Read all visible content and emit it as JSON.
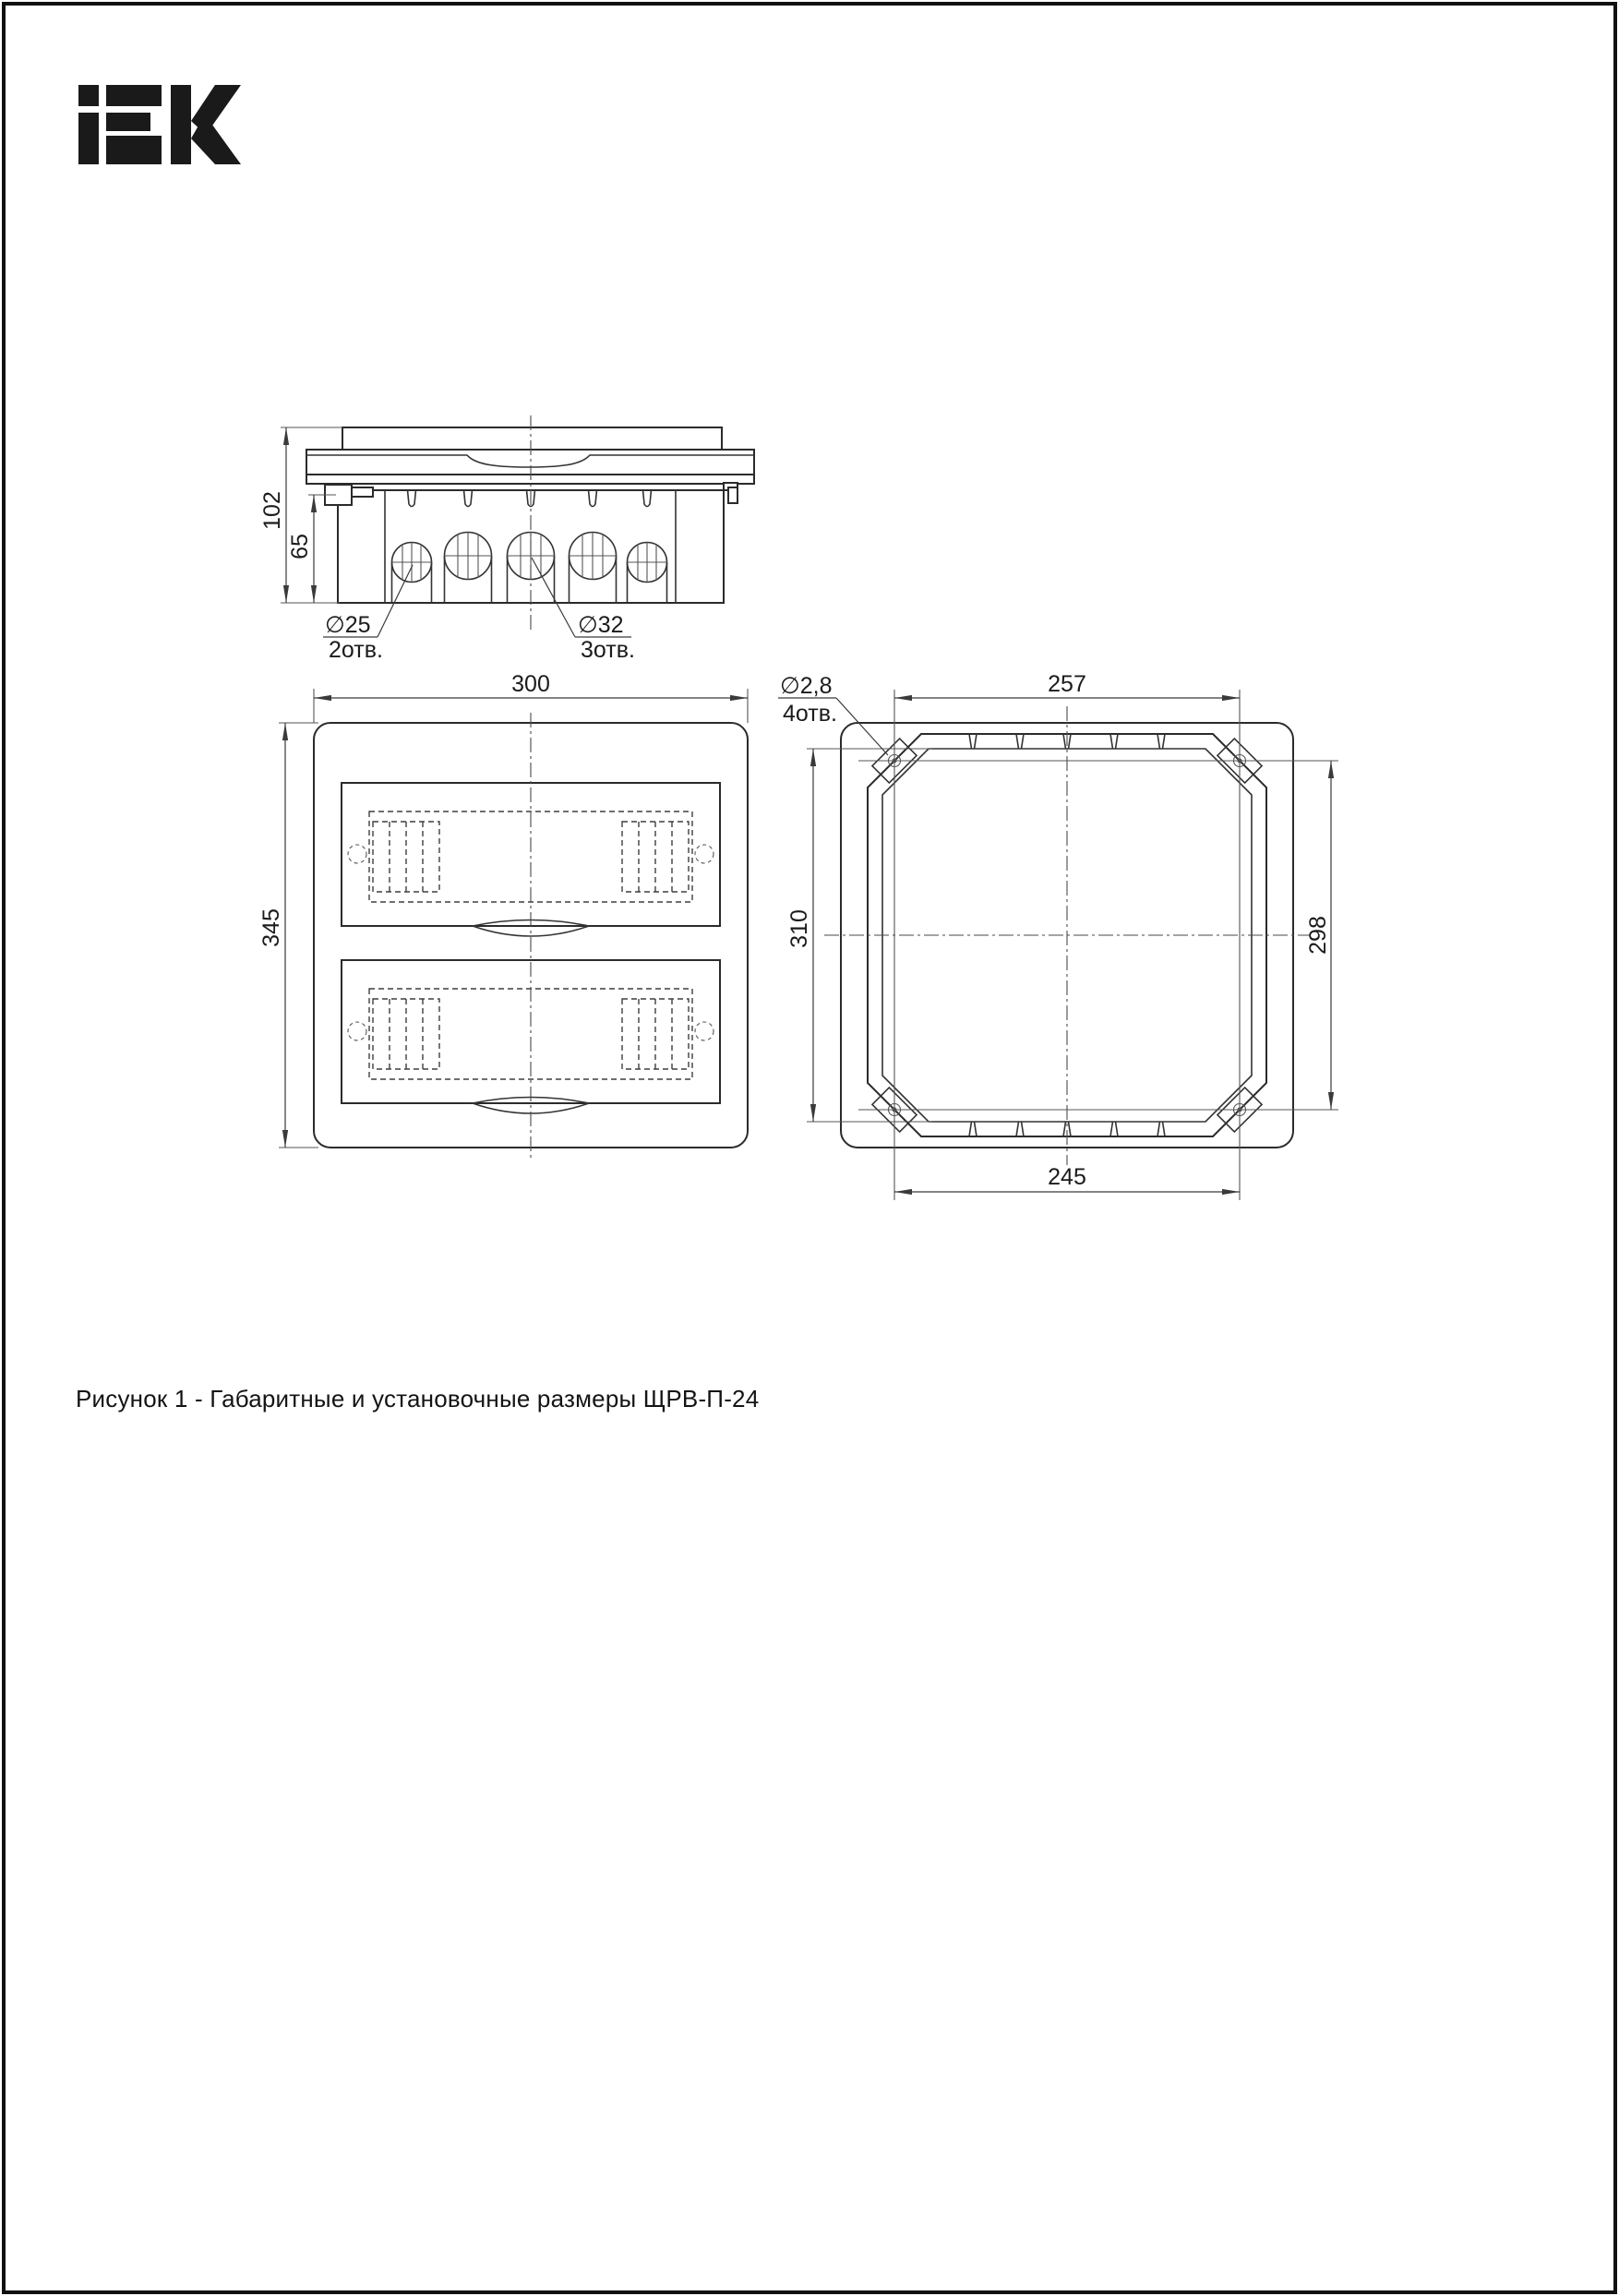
{
  "page": {
    "logo_text": "iEK",
    "caption": "Рисунок 1 - Габаритные и установочные размеры ЩРВ-П-24"
  },
  "side_view": {
    "dim_overall_height": "102",
    "dim_body_height": "65",
    "label_small_hole_dia": "∅25",
    "label_small_hole_count": "2отв.",
    "label_large_hole_dia": "∅32",
    "label_large_hole_count": "3отв."
  },
  "front_view": {
    "dim_width": "300",
    "dim_height": "345"
  },
  "rear_view": {
    "label_mount_hole_dia": "∅2,8",
    "label_mount_hole_count": "4отв.",
    "dim_hole_span_top": "257",
    "dim_cutout_height": "310",
    "dim_hole_span_right": "298",
    "dim_hole_span_bottom": "245"
  },
  "colors": {
    "line": "#2b2b2b",
    "dim_line": "#3a3a3a",
    "text": "#1b1b1b",
    "logo": "#1a1a1a",
    "background": "#ffffff"
  }
}
